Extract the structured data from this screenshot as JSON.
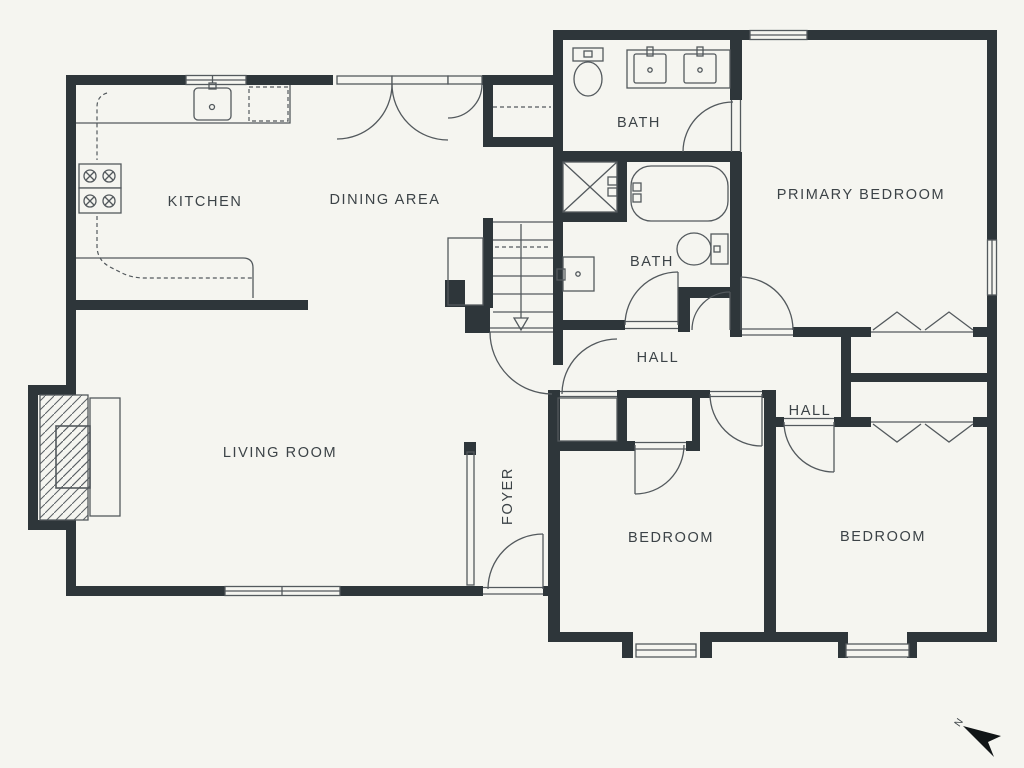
{
  "plan": {
    "title": "floor-plan",
    "colors": {
      "bg": "#f5f5f0",
      "wall": "#2e363a",
      "line": "#53595d",
      "text": "#3c4347"
    },
    "rooms": [
      {
        "id": "kitchen",
        "label": "KITCHEN"
      },
      {
        "id": "dining-area",
        "label": "DINING AREA"
      },
      {
        "id": "bath-upper",
        "label": "BATH"
      },
      {
        "id": "primary-bedroom",
        "label": "PRIMARY BEDROOM"
      },
      {
        "id": "bath-middle",
        "label": "BATH"
      },
      {
        "id": "hall-main",
        "label": "HALL"
      },
      {
        "id": "hall-right",
        "label": "HALL"
      },
      {
        "id": "living-room",
        "label": "LIVING ROOM"
      },
      {
        "id": "foyer",
        "label": "FOYER"
      },
      {
        "id": "bedroom-left",
        "label": "BEDROOM"
      },
      {
        "id": "bedroom-right",
        "label": "BEDROOM"
      }
    ],
    "compass": {
      "label": "N"
    }
  }
}
